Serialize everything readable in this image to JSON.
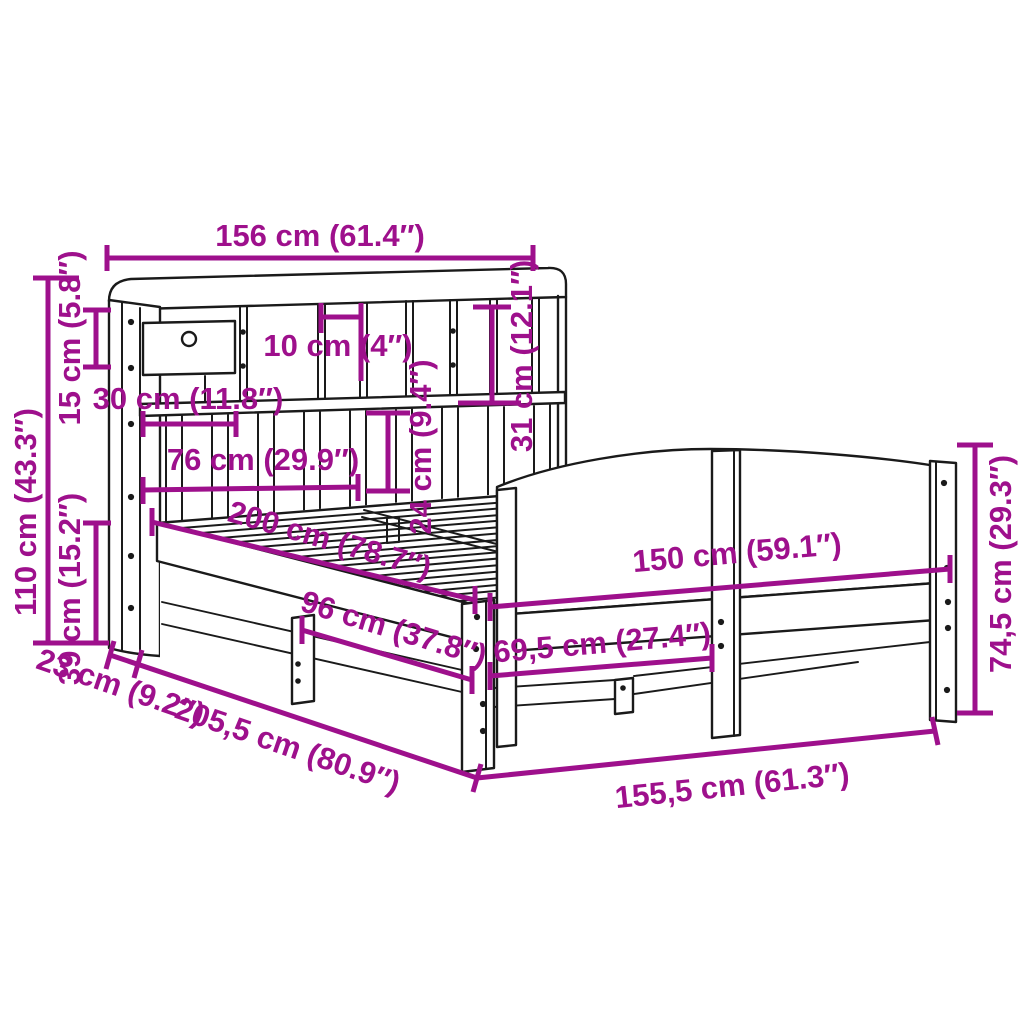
{
  "diagram": {
    "title": "Bookcase bed frame dimension diagram",
    "background_color": "#ffffff",
    "line_color": "#1a1a1a",
    "dimension_color": "#9e108c"
  },
  "dims": {
    "headboard_width": "156 cm (61.4″)",
    "total_height": "110 cm (43.3″)",
    "top_section_height": "15 cm (5.8″)",
    "base_height": "39 cm (15.2″)",
    "headboard_depth": "23 cm (9.2″)",
    "drawer_width": "30 cm (11.8″)",
    "cubby_width": "10 cm (4″)",
    "lower_shelf_width": "76 cm (29.9″)",
    "lower_shelf_height": "24 cm (9.4″)",
    "cubby_height": "31 cm (12.1″)",
    "bed_length": "200 cm (78.7″)",
    "side_rail_length": "96 cm (37.8″)",
    "foot_section_length": "69,5 cm (27.4″)",
    "footboard_width": "150 cm (59.1″)",
    "footboard_height": "74,5 cm (29.3″)",
    "total_length": "205,5 cm (80.9″)",
    "footboard_total_width": "155,5 cm (61.3″)"
  }
}
